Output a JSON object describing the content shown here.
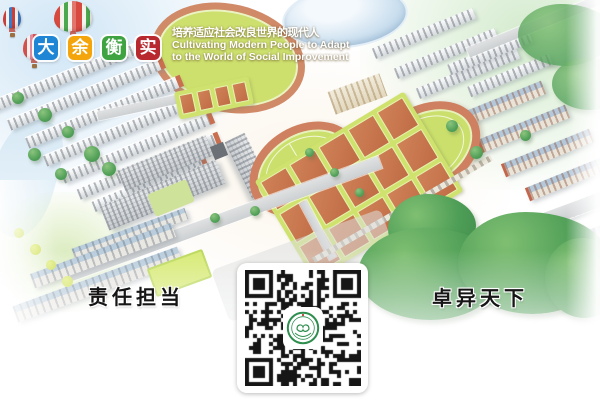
{
  "brand": {
    "logo": [
      {
        "char": "大",
        "color": "#1e86d4"
      },
      {
        "char": "余",
        "color": "#f3a50b"
      },
      {
        "char": "衡",
        "color": "#3fa342"
      },
      {
        "char": "实",
        "color": "#b8292f"
      }
    ],
    "slogan_zh": "培养适应社会改良世界的现代人",
    "slogan_en_line1": "Cultivating Modern People to Adapt",
    "slogan_en_line2": "to the World of Social Improvement"
  },
  "captions": {
    "left": "责任担当",
    "right": "卓异天下"
  },
  "qr": {
    "emblem": "school-seal"
  },
  "palette": {
    "track": "#cf8060",
    "field": "#cbe06c",
    "court": "#c9764f",
    "tree": "#4f9e57",
    "roof_blue": "#b7cadb",
    "building_gray": "#d6d9dc",
    "seal_green": "#2e8e4e"
  }
}
